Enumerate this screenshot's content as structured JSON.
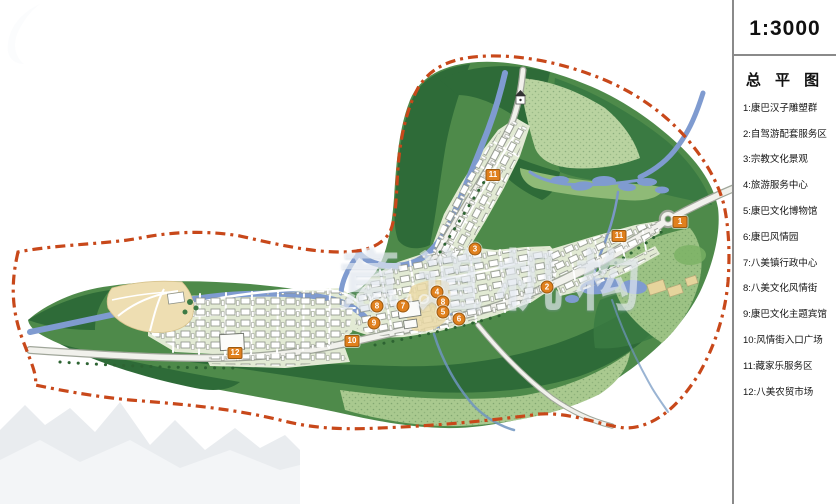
{
  "sidebar": {
    "scale": "1:3000",
    "title": "总 平 图",
    "legend": [
      "1:康巴汉子雕塑群",
      "2:自驾游配套服务区",
      "3:宗教文化景观",
      "4:旅游服务中心",
      "5:康巴文化博物馆",
      "6:康巴风情园",
      "7:八美镇行政中心",
      "8:八美文化风情街",
      "9:康巴文化主题宾馆",
      "10:风情街入口广场",
      "11:藏家乐服务区",
      "12:八美农贸市场"
    ]
  },
  "watermark": {
    "cn": "意道机构",
    "en": "YIDAO"
  },
  "map": {
    "colors": {
      "boundary": "#c8481a",
      "marker": "#e0801e",
      "river": "#7f9bd0",
      "forest_dark": "#2e6b38",
      "green_mid": "#4e8a4a",
      "hill_light": "#b9d3a0",
      "plaza_beige": "#eedeb2"
    },
    "markers": [
      {
        "n": "1",
        "x": 680,
        "y": 222,
        "shape": "square"
      },
      {
        "n": "11",
        "x": 619,
        "y": 236,
        "shape": "square"
      },
      {
        "n": "2",
        "x": 547,
        "y": 287,
        "shape": "circle"
      },
      {
        "n": "3",
        "x": 475,
        "y": 249,
        "shape": "circle"
      },
      {
        "n": "4",
        "x": 437,
        "y": 292,
        "shape": "circle"
      },
      {
        "n": "8",
        "x": 443,
        "y": 302,
        "shape": "circle"
      },
      {
        "n": "5",
        "x": 443,
        "y": 312,
        "shape": "circle"
      },
      {
        "n": "6",
        "x": 459,
        "y": 319,
        "shape": "circle"
      },
      {
        "n": "7",
        "x": 403,
        "y": 306,
        "shape": "circle"
      },
      {
        "n": "8",
        "x": 377,
        "y": 306,
        "shape": "circle"
      },
      {
        "n": "9",
        "x": 374,
        "y": 323,
        "shape": "circle"
      },
      {
        "n": "10",
        "x": 352,
        "y": 341,
        "shape": "square"
      },
      {
        "n": "11",
        "x": 493,
        "y": 175,
        "shape": "square"
      },
      {
        "n": "12",
        "x": 235,
        "y": 353,
        "shape": "square"
      }
    ]
  }
}
